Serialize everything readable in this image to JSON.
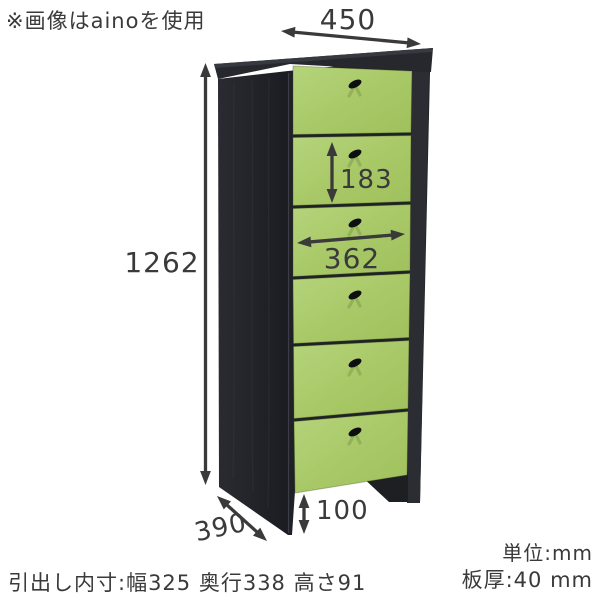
{
  "note_top": "※画像はainoを使用",
  "diagram": {
    "type": "furniture-dimension-diagram",
    "drawer_count": 6,
    "unit": "mm",
    "dimensions": {
      "overall_width": "450",
      "overall_height": "1262",
      "overall_depth": "390",
      "drawer_front_height": "183",
      "drawer_front_width": "362",
      "base_clearance": "100"
    },
    "colors": {
      "drawer_front_green": "#a9c968",
      "cabinet_body_black": "#24252a",
      "dimension_lines": "#3a3a3a"
    }
  },
  "footer": {
    "drawer_inner_note": "引出し内寸:幅325 奥行338 高さ91",
    "unit_note": "単位:mm",
    "thickness_note": "板厚:40 mm"
  }
}
